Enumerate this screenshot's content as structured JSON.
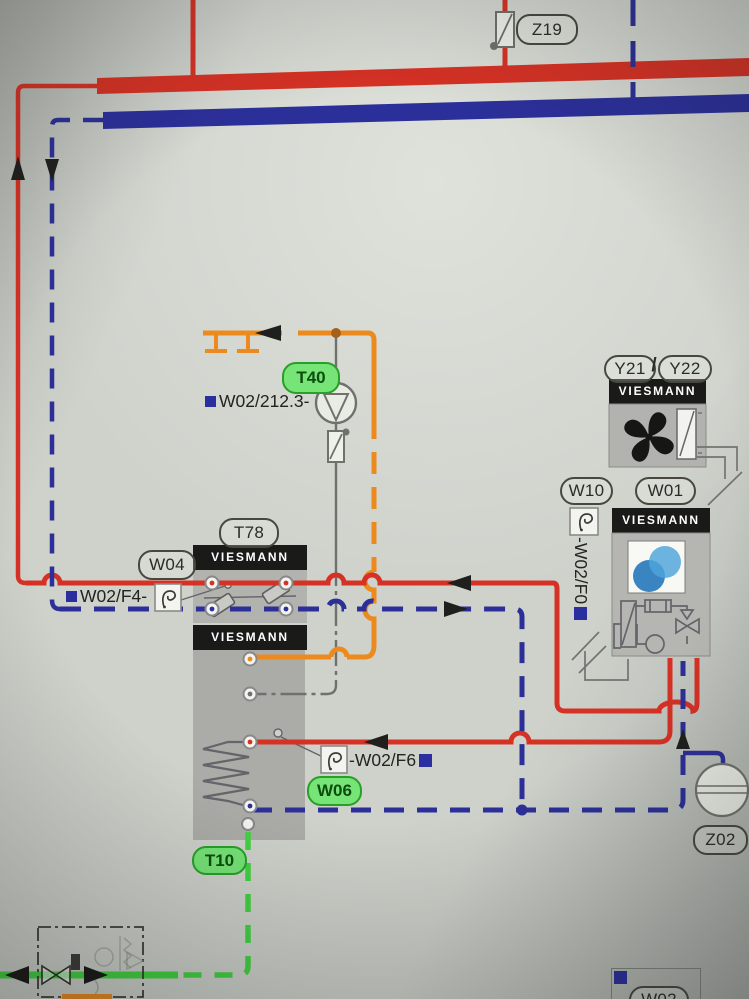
{
  "brand": "VIESMANN",
  "labels": {
    "z19": "Z19",
    "t40": "T40",
    "pump_ref": "W02/212.3-",
    "y21": "Y21",
    "separator": "/",
    "y22": "Y22",
    "w10": "W10",
    "w01": "W01",
    "f0_ref": "-W02/F0",
    "t78": "T78",
    "w04": "W04",
    "f4_ref": "W02/F4-",
    "f6_ref": "-W02/F6",
    "w06": "W06",
    "t10": "T10",
    "z02": "Z02",
    "w02": "W02"
  },
  "colors": {
    "flow_red": "#d93023",
    "return_blue": "#2c2f9a",
    "control_orange": "#ef8a1a",
    "signal_green": "#3ed43e",
    "sensor_gray": "#70706c",
    "label_green_fill": "#76e476",
    "marker_navy": "#2a2e9e",
    "unit_header_black": "#1a1a18",
    "unit_body_gray": "#b2b3ae"
  }
}
